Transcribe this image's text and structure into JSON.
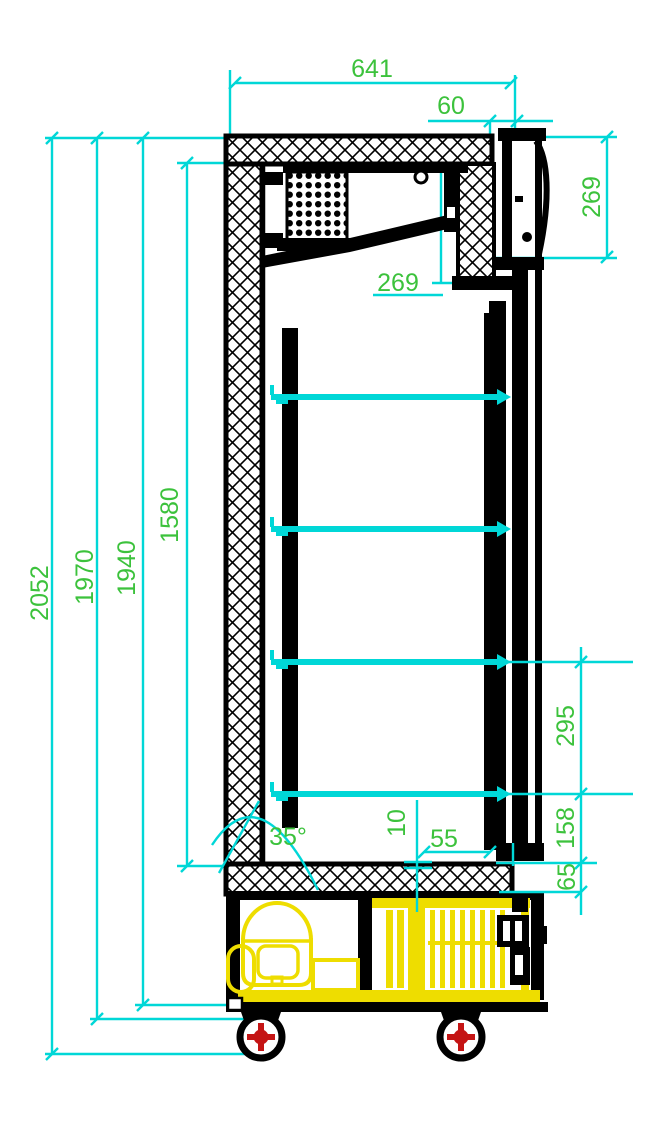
{
  "drawing": {
    "type": "technical-drawing",
    "subject": "single-glass-door-refrigerator-side-section",
    "colors": {
      "dimension_line": "#00d7d7",
      "dimension_text": "#3cc23c",
      "outline": "#000000",
      "highlight_components": "#eedd00",
      "caster_accent": "#c41414",
      "background": "#ffffff"
    },
    "shelves": {
      "count": 4
    },
    "dimensions": {
      "overall_depth": "641",
      "door_frame_depth": "60",
      "top_section_height": "269",
      "evaporator_section_depth": "269",
      "overall_height": "2052",
      "height_to_base": "1970",
      "body_height": "1940",
      "interior_height": "1580",
      "shelf_pitch": "295",
      "lower_section_height": "158",
      "floor_thickness": "65",
      "shelf_clearance": "55",
      "gap": "10",
      "base_angle": "35°"
    }
  }
}
